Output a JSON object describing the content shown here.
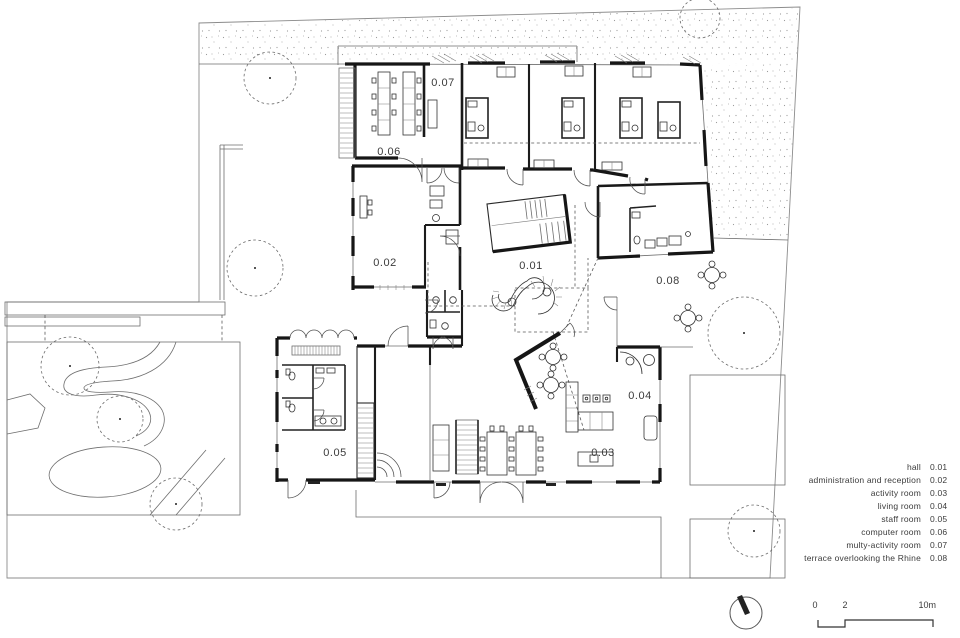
{
  "rooms": {
    "r01": "0.01",
    "r02": "0.02",
    "r03": "0.03",
    "r04": "0.04",
    "r05": "0.05",
    "r06": "0.06",
    "r07": "0.07",
    "r08": "0.08"
  },
  "legend": {
    "items": [
      {
        "name": "hall",
        "code": "0.01"
      },
      {
        "name": "administration and reception",
        "code": "0.02"
      },
      {
        "name": "activity room",
        "code": "0.03"
      },
      {
        "name": "living room",
        "code": "0.04"
      },
      {
        "name": "staff room",
        "code": "0.05"
      },
      {
        "name": "computer room",
        "code": "0.06"
      },
      {
        "name": "multy-activity room",
        "code": "0.07"
      },
      {
        "name": "terrace overlooking the Rhine",
        "code": "0.08"
      }
    ]
  },
  "scalebar": {
    "tick_start": "0",
    "tick_mid": "2",
    "tick_end": "10m"
  },
  "colors": {
    "wall": "#161616",
    "text": "#3b3b3b",
    "paper": "#ffffff"
  }
}
